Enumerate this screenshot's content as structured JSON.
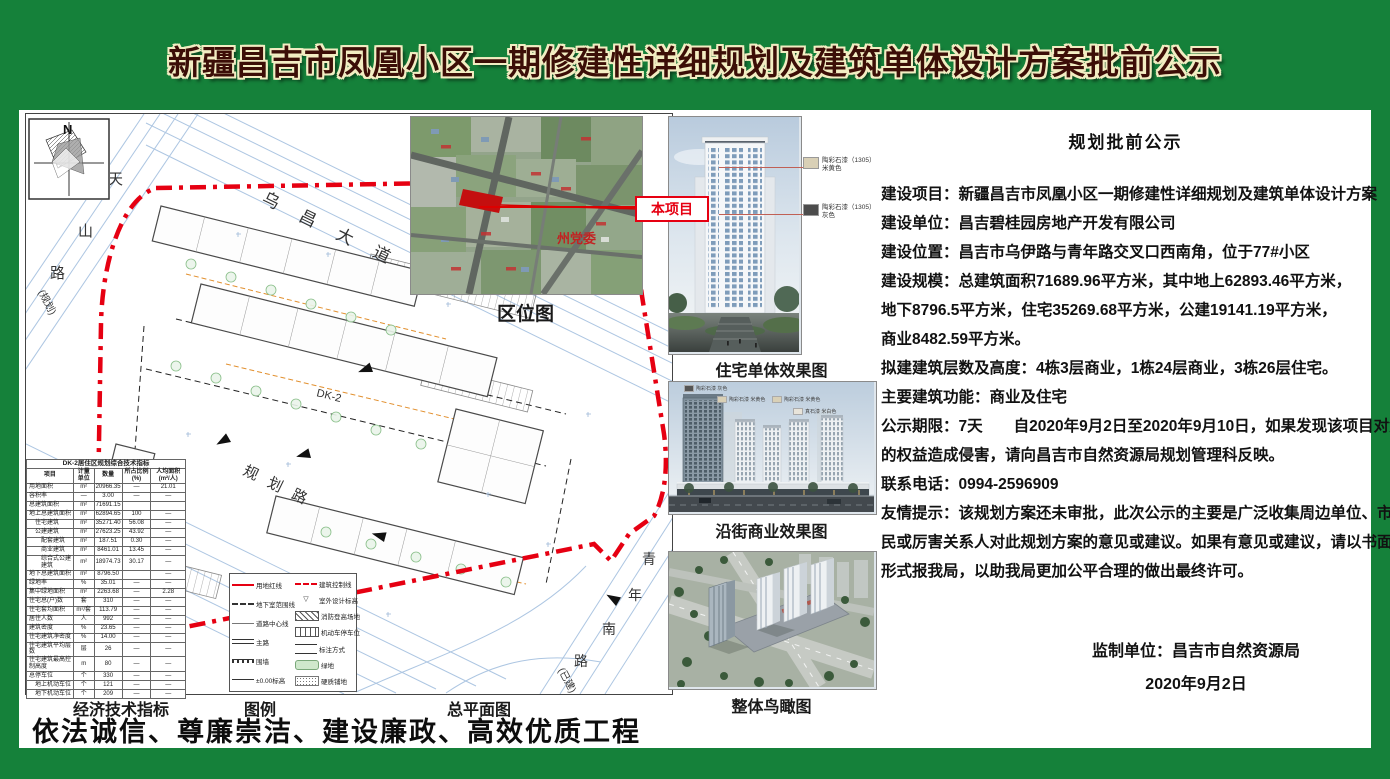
{
  "page": {
    "title": "新疆昌吉市凤凰小区一期修建性详细规划及建筑单体设计方案批前公示",
    "slogan": "依法诚信、尊廉崇洁、建设廉政、高效优质工程"
  },
  "colors": {
    "frame_green": "#15813a",
    "title_fill": "#3c0e07",
    "title_outline": "#f2edc2",
    "boundary_red": "#e60012"
  },
  "plan": {
    "caption": "总平面图",
    "compass_label": "N",
    "block_label": "DK-2",
    "roads": {
      "top": "乌昌大道",
      "left_1": "天",
      "left_2": "山",
      "left_3": "路",
      "left_note": "(规划)",
      "bottom": "规划路",
      "right_1": "青",
      "right_2": "年",
      "right_3": "南",
      "right_4": "路",
      "right_note": "(已建)"
    }
  },
  "location_map": {
    "caption": "区位图",
    "site_label": "本项目",
    "landmark_label": "州党委"
  },
  "eco_table": {
    "caption": "经济技术指标",
    "title": "DK-2居住区规划综合技术指标",
    "headers": [
      "项目",
      "计量单位",
      "数量",
      "所占比例(%)",
      "人均面积(m²/人)"
    ],
    "rows": [
      [
        "用地面积",
        "m²",
        "20966.35",
        "—",
        "21.01",
        0
      ],
      [
        "容积率",
        "—",
        "3.00",
        "—",
        "—",
        0
      ],
      [
        "总建筑面积",
        "m²",
        "71691.15",
        "",
        "",
        0
      ],
      [
        "地上总建筑面积",
        "m²",
        "62894.65",
        "100",
        "—",
        0
      ],
      [
        "住宅建筑",
        "m²",
        "35271.40",
        "56.08",
        "—",
        1
      ],
      [
        "公建建筑",
        "m²",
        "27623.25",
        "43.92",
        "—",
        1
      ],
      [
        "配套建筑",
        "m²",
        "187.51",
        "0.30",
        "—",
        2
      ],
      [
        "商业建筑",
        "m²",
        "8461.01",
        "13.45",
        "—",
        2
      ],
      [
        "综合式公建建筑",
        "m²",
        "18974.73",
        "30.17",
        "—",
        2
      ],
      [
        "地下总建筑面积",
        "m²",
        "8796.50",
        "",
        "—",
        0
      ],
      [
        "绿地率",
        "%",
        "35.01",
        "—",
        "—",
        0
      ],
      [
        "集中绿地面积",
        "m²",
        "2263.68",
        "—",
        "2.28",
        0
      ],
      [
        "住宅总(户)数",
        "套",
        "310",
        "—",
        "—",
        0
      ],
      [
        "住宅套均面积",
        "m²/套",
        "113.79",
        "—",
        "—",
        0
      ],
      [
        "居住人数",
        "人",
        "992",
        "—",
        "—",
        0
      ],
      [
        "建筑密度",
        "%",
        "23.65",
        "—",
        "—",
        0
      ],
      [
        "住宅建筑净密度",
        "%",
        "14.00",
        "—",
        "—",
        0
      ],
      [
        "住宅建筑平均层数",
        "层",
        "26",
        "—",
        "—",
        0
      ],
      [
        "住宅建筑最高控制高度",
        "m",
        "80",
        "—",
        "—",
        0
      ],
      [
        "总停车位",
        "个",
        "330",
        "—",
        "—",
        0
      ],
      [
        "地上机动车位",
        "个",
        "121",
        "—",
        "—",
        1
      ],
      [
        "地下机动车位",
        "个",
        "209",
        "—",
        "—",
        1
      ]
    ]
  },
  "legend": {
    "caption": "图例",
    "col1": [
      {
        "s": "redline",
        "l": "用地红线"
      },
      {
        "s": "dash",
        "l": "地下室范围线"
      },
      {
        "s": "thin",
        "l": "道路中心线"
      },
      {
        "s": "mainroad",
        "l": "主路"
      },
      {
        "s": "wall",
        "l": "围墙"
      },
      {
        "s": "elev",
        "l": "±0.00标高"
      }
    ],
    "col2": [
      {
        "s": "reddashdot",
        "l": "建筑控制线"
      },
      {
        "s": "spot",
        "l": "室外设计标高"
      },
      {
        "s": "hatch",
        "l": "消防登高场地"
      },
      {
        "s": "parking",
        "l": "机动车停车位"
      },
      {
        "s": "frac",
        "l": "标注方式"
      },
      {
        "s": "green",
        "l": "绿地"
      },
      {
        "s": "paving",
        "l": "硬质铺地"
      }
    ]
  },
  "renderings": {
    "residential": {
      "caption": "住宅单体效果图",
      "callouts": [
        {
          "material": "陶彩石漆（1305）",
          "color_name": "米黄色",
          "swatch": "#d9d0b6"
        },
        {
          "material": "陶彩石漆（1305）",
          "color_name": "灰色",
          "swatch": "#4c4c4c"
        }
      ]
    },
    "commercial": {
      "caption": "沿街商业效果图",
      "callouts": [
        "陶彩石漆 灰色",
        "陶彩石漆 米黄色",
        "陶彩石漆 米黄色",
        "真石漆 米白色"
      ]
    },
    "aerial": {
      "caption": "整体鸟瞰图"
    }
  },
  "notice": {
    "heading": "规划批前公示",
    "lines": [
      "建设项目：新疆昌吉市凤凰小区一期修建性详细规划及建筑单体设计方案",
      "建设单位：昌吉碧桂园房地产开发有限公司",
      "建设位置：昌吉市乌伊路与青年路交叉口西南角，位于77#小区",
      "建设规模：总建筑面积71689.96平方米，其中地上62893.46平方米，",
      "地下8796.5平方米，住宅35269.68平方米，公建19141.19平方米，",
      "商业8482.59平方米。",
      "拟建建筑层数及高度：4栋3层商业，1栋24层商业，3栋26层住宅。",
      "主要建筑功能：商业及住宅",
      "公示期限：7天　　自2020年9月2日至2020年9月10日，如果发现该项目对您",
      "的权益造成侵害，请向昌吉市自然资源局规划管理科反映。",
      "联系电话：0994-2596909",
      "友情提示：该规划方案还未审批，此次公示的主要是广泛收集周边单位、市",
      "民或厉害关系人对此规划方案的意见或建议。如果有意见或建议，请以书面",
      "形式报我局，以助我局更加公平合理的做出最终许可。"
    ],
    "supervisor": "监制单位：昌吉市自然资源局",
    "date": "2020年9月2日"
  }
}
